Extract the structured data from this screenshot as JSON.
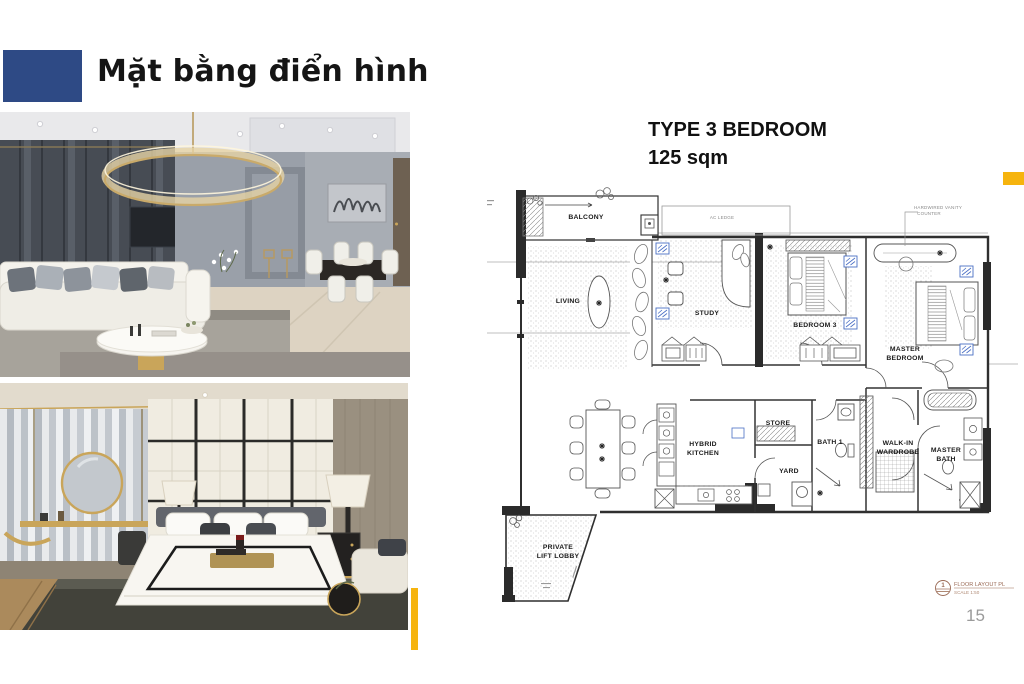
{
  "slide": {
    "title": "Mặt bằng điển hình",
    "page_number": "15",
    "accent_blue": "#2E4A85",
    "accent_yellow": "#F6B40E"
  },
  "plan": {
    "heading": "TYPE 3 BEDROOM",
    "subheading": "125 sqm",
    "fcu_blue": "#4a6fc4",
    "labels": {
      "balcony": "BALCONY",
      "living": "LIVING",
      "study": "STUDY",
      "bedroom3": "BEDROOM 3",
      "master1": "MASTER",
      "master2": "BEDROOM",
      "kitchen1": "HYBRID",
      "kitchen2": "KITCHEN",
      "store": "STORE",
      "yard": "YARD",
      "bath1": "BATH 1",
      "walkin1": "WALK-IN",
      "walkin2": "WARDROBE",
      "mbath1": "MASTER",
      "mbath2": "BATH",
      "lobby1": "PRIVATE",
      "lobby2": "LIFT LOBBY",
      "ledge": "AC LEDGE"
    },
    "callout": {
      "line1": "HARDWIRED VANITY",
      "line2": "COUNTER"
    },
    "title_block": {
      "number": "1",
      "name": "FLOOR LAYOUT PL",
      "scale": "SCALE 1:50"
    }
  }
}
